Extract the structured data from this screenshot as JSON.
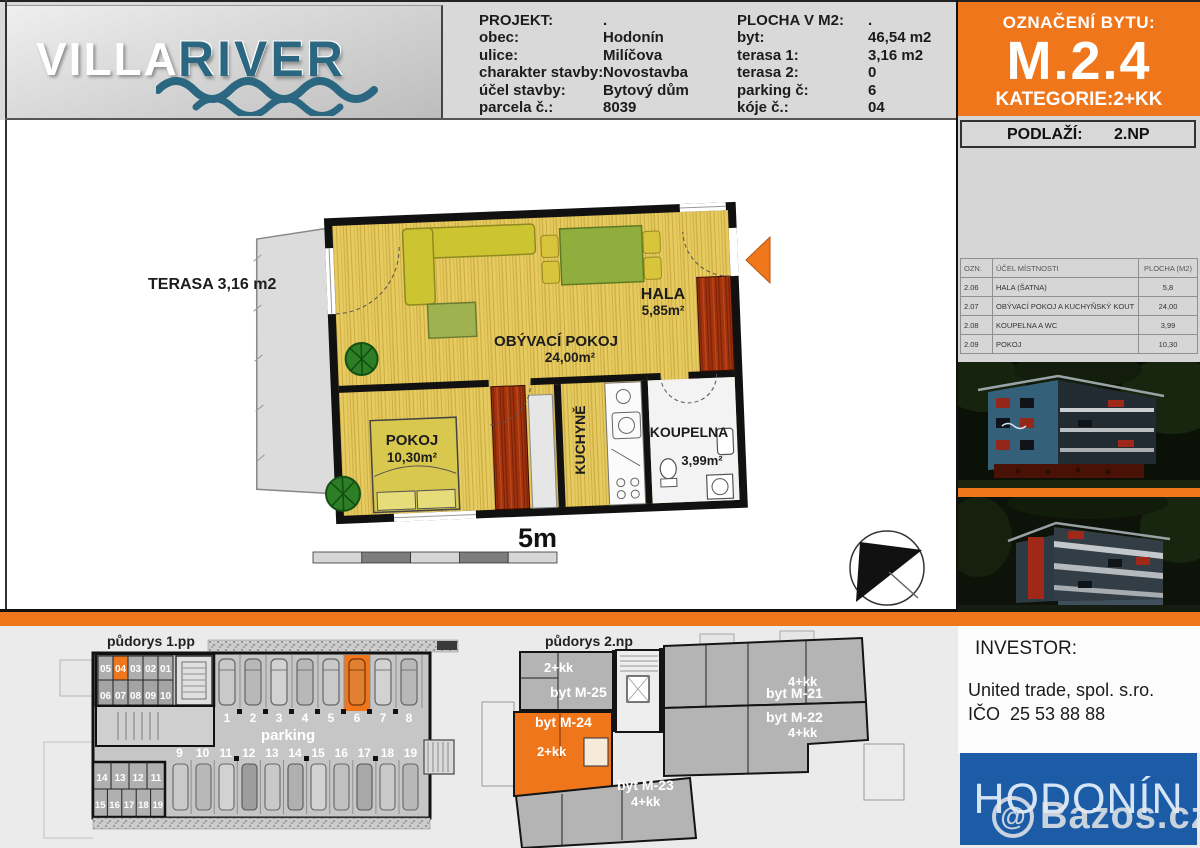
{
  "header": {
    "logo": {
      "word1": "VILLA",
      "word2": "RIVER"
    },
    "projekt": {
      "title_label": "PROJEKT:",
      "title_value": ".",
      "rows": [
        {
          "label": "obec:",
          "value": "Hodonín"
        },
        {
          "label": "ulice:",
          "value": "Milíčova"
        },
        {
          "label": "charakter stavby:",
          "value": "Novostavba"
        },
        {
          "label": "účel stavby:",
          "value": "Bytový dům"
        },
        {
          "label": "parcela č.:",
          "value": "8039"
        }
      ]
    },
    "plocha": {
      "title_label": "PLOCHA V M2:",
      "title_value": ".",
      "rows": [
        {
          "label": "byt:",
          "value": "46,54 m2"
        },
        {
          "label": "terasa 1:",
          "value": "3,16 m2"
        },
        {
          "label": "terasa 2:",
          "value": "0"
        },
        {
          "label": "parking č:",
          "value": "6"
        },
        {
          "label": "kóje č.:",
          "value": "04"
        }
      ]
    },
    "oznaceni": {
      "label": "OZNAČENÍ BYTU:",
      "unit": "M.2.4",
      "kategorie": "KATEGORIE:2+KK"
    }
  },
  "sidebar": {
    "podlazi_label": "PODLAŽÍ:",
    "podlazi_value": "2.NP",
    "room_table": {
      "col_ozn": "OZN.",
      "col_ucel": "ÚČEL MÍSTNOSTI",
      "col_plocha": "PLOCHA (M2)",
      "rows": [
        {
          "ozn": "2.06",
          "ucel": "HALA (ŠATNA)",
          "plocha": "5,8"
        },
        {
          "ozn": "2.07",
          "ucel": "OBÝVACÍ POKOJ A KUCHYŇSKÝ KOUT",
          "plocha": "24,00"
        },
        {
          "ozn": "2.08",
          "ucel": "KOUPELNA A WC",
          "plocha": "3,99"
        },
        {
          "ozn": "2.09",
          "ucel": "POKOJ",
          "plocha": "10,30"
        }
      ]
    },
    "investor": {
      "title": "INVESTOR:",
      "company": "United trade, spol. s.ro.",
      "ico": "IČO  25 53 88 88"
    },
    "city": "HODONÍN"
  },
  "floorplan": {
    "terasa": "TERASA 3,16 m2",
    "hala_name": "HALA",
    "hala_area": "5,85m²",
    "obyvaci_name": "OBÝVACÍ POKOJ",
    "obyvaci_area": "24,00m²",
    "pokoj_name": "POKOJ",
    "pokoj_area": "10,30m²",
    "kuchyne_name": "KUCHYNĚ",
    "koupelna_name": "KOUPELNA",
    "koupelna_area": "3,99m²",
    "scale": "5m"
  },
  "plans": {
    "plan1": {
      "title": "půdorys 1.pp",
      "parking_label": "parking",
      "highlighted_space": "6",
      "highlighted_box": "04",
      "spaces_top": [
        "1",
        "2",
        "3",
        "4",
        "5",
        "6",
        "7",
        "8"
      ],
      "spaces_bottom": [
        "9",
        "10",
        "11",
        "12",
        "13",
        "14",
        "15",
        "16",
        "17",
        "18",
        "19"
      ],
      "boxesA_top": [
        "05",
        "04",
        "03",
        "02",
        "01"
      ],
      "boxesA_bottom": [
        "06",
        "07",
        "08",
        "09",
        "10"
      ],
      "boxesB_top": [
        "14",
        "13",
        "12",
        "11"
      ],
      "boxesB_bottom": [
        "15",
        "16",
        "17",
        "18",
        "19"
      ]
    },
    "plan2": {
      "title": "půdorys 2.np",
      "m25": "byt M-25",
      "m25_type": "2+kk",
      "m24": "byt M-24",
      "m24_type": "2+kk",
      "m23": "byt M-23",
      "m23_type": "4+kk",
      "m21": "byt M-21",
      "m21_type": "4+kk",
      "m22": "byt M-22",
      "m22_type": "4+kk"
    }
  },
  "watermark": {
    "at": "@",
    "text": "Bazos.cz"
  },
  "colors": {
    "accent_orange": "#F0761C",
    "brand_blue": "#1C5CA6",
    "logo_teal": "#2B6780"
  }
}
